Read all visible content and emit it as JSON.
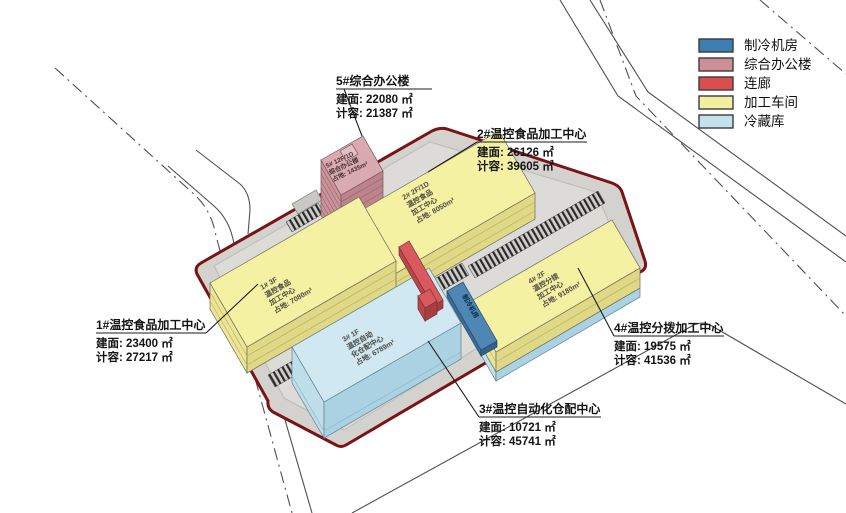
{
  "legend": {
    "items": [
      {
        "label": "制冷机房",
        "color": "#3d7fb3"
      },
      {
        "label": "综合办公楼",
        "color": "#cc8f94"
      },
      {
        "label": "连廊",
        "color": "#d94f4f"
      },
      {
        "label": "加工车间",
        "color": "#f3efa0"
      },
      {
        "label": "冷藏库",
        "color": "#c3e2ee"
      }
    ]
  },
  "colors": {
    "workshop_roof": "#f5f1a3",
    "cold_roof": "#cfe8f2",
    "office_roof": "#d9aab0",
    "corridor_roof": "#d85a5e",
    "chiller_strip": "#4e86b4",
    "site_boundary": "#7a1316"
  },
  "callouts": {
    "b5": {
      "title": "5#综合办公楼",
      "built": "建面: 22080 ㎡",
      "ratio": "计容: 21387 ㎡"
    },
    "b2": {
      "title": "2#温控食品加工中心",
      "built": "建面: 26126 ㎡",
      "ratio": "计容: 39605 ㎡"
    },
    "b1": {
      "title": "1#温控食品加工中心",
      "built": "建面: 23400 ㎡",
      "ratio": "计容: 27217 ㎡"
    },
    "b4": {
      "title": "4#温控分拨加工中心",
      "built": "建面: 19575 ㎡",
      "ratio": "计容: 41536 ㎡"
    },
    "b3": {
      "title": "3#温控自动化仓配中心",
      "built": "建面: 10721 ㎡",
      "ratio": "计容: 45741 ㎡"
    }
  },
  "roof_labels": {
    "b5": [
      "5#  12F/1D",
      "综合办公楼",
      "占地: 1435m²"
    ],
    "b2": [
      "2#  2F/1D",
      "温控食品",
      "加工中心",
      "占地: 8050m²"
    ],
    "b1": [
      "1#  3F",
      "温控食品",
      "加工中心",
      "占地: 7080m²"
    ],
    "b4": [
      "4#  2F",
      "温控分拨",
      "加工中心",
      "占地: 9180m²"
    ],
    "b3": [
      "3#  1F",
      "温控自动",
      "化仓配中心",
      "占地: 6789m²"
    ],
    "chiller": "制冷机房"
  }
}
